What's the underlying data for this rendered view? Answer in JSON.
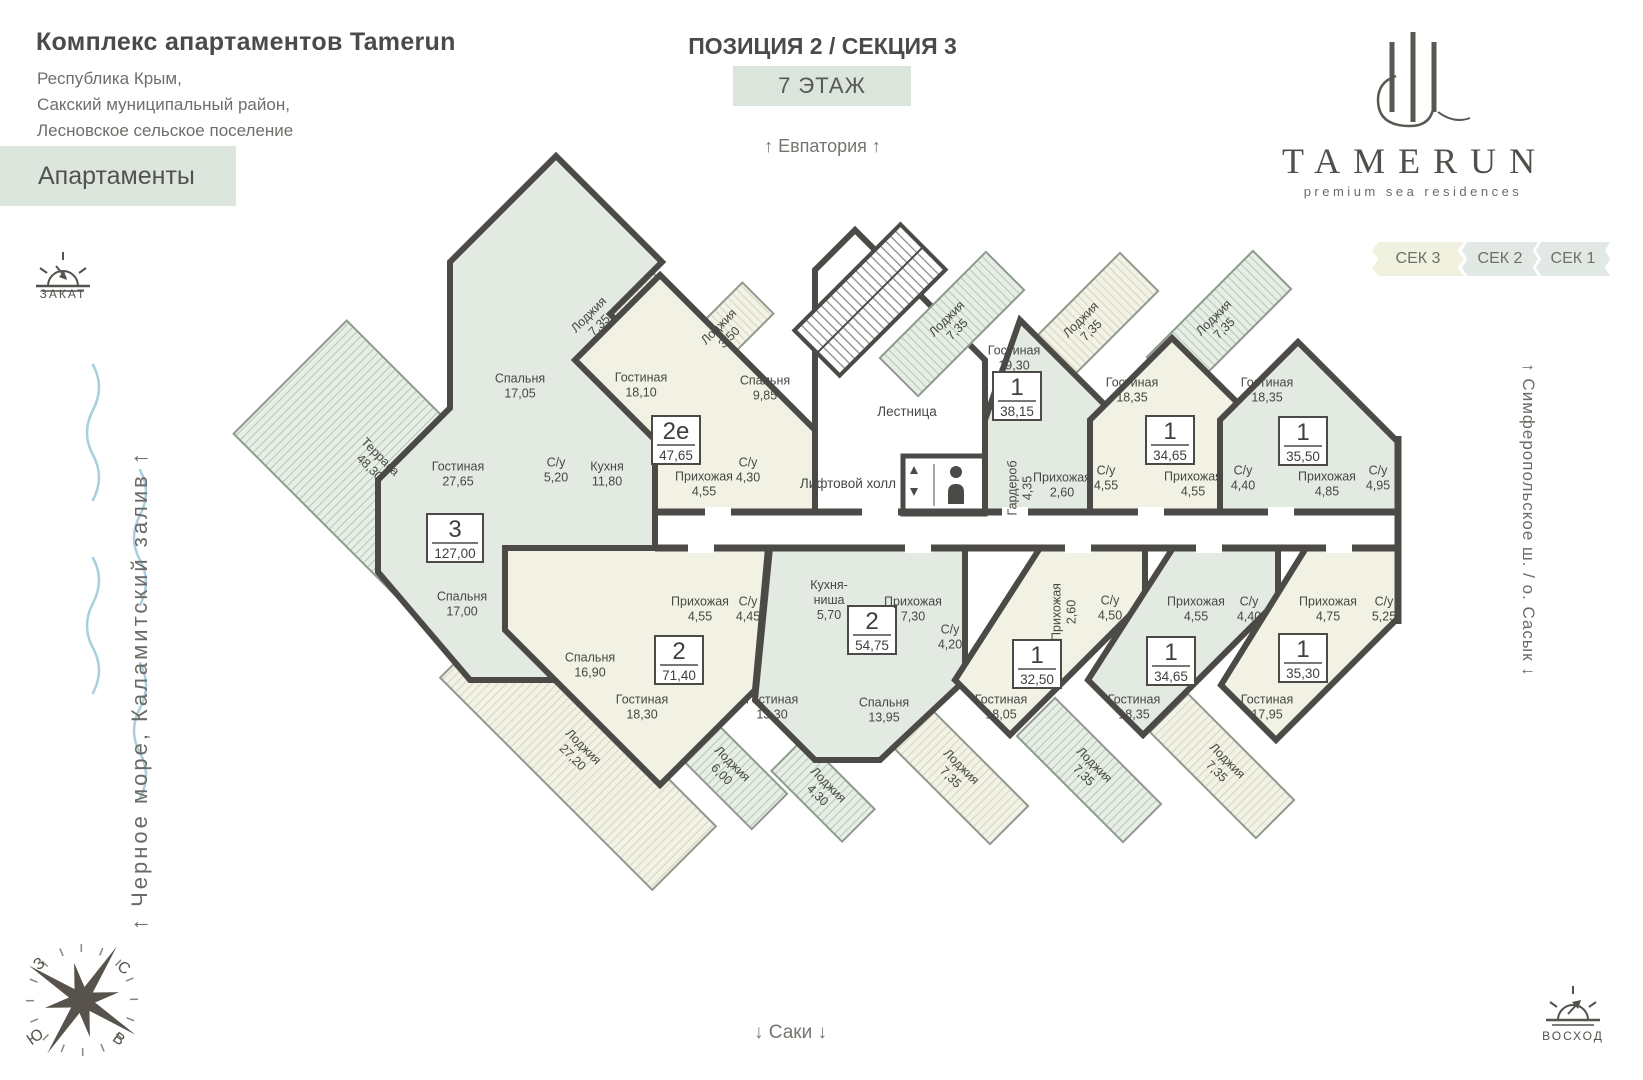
{
  "header": {
    "title": "Комплекс апартаментов Tamerun",
    "address": [
      "Республика Крым,",
      "Сакский муниципальный район,",
      "Лесновское сельское поселение"
    ],
    "apartments_badge": "Апартаменты",
    "position_title": "ПОЗИЦИЯ 2 / СЕКЦИЯ 3",
    "floor_badge": "7 ЭТАЖ",
    "direction_top": "↑ Евпатория ↑",
    "logo_word": "TAMERUN",
    "logo_tagline": "premium sea residences",
    "tabs": [
      {
        "id": "sec3",
        "label": "СЕК 3"
      },
      {
        "id": "sec2",
        "label": "СЕК 2"
      },
      {
        "id": "sec1",
        "label": "СЕК 1"
      }
    ]
  },
  "environment": {
    "sunset_label": "ЗАКАТ",
    "sunrise_label": "ВОСХОД",
    "left_vertical": "↑ Черное море, Каламитский залив ↑",
    "right_vertical": "↑ Симферопольское ш. / о. Сасык ↓",
    "direction_bottom": "↓ Саки ↓",
    "compass": {
      "n": "С",
      "s": "Ю",
      "w": "З",
      "e": "В"
    }
  },
  "plan": {
    "common_labels": [
      {
        "text": "Лестница",
        "x": 907,
        "y": 416
      },
      {
        "text": "Лифтовой холл",
        "x": 848,
        "y": 488
      }
    ],
    "colors": {
      "wall": "#4b4a47",
      "green": "#e3eae2",
      "cream": "#f1f1e4",
      "badge_bg": "#dde6dc"
    },
    "apartments": [
      {
        "id": "apt-3",
        "type": "3",
        "area": "127,00",
        "color": "green",
        "badge": {
          "x": 455,
          "y": 540
        },
        "shape": [
          [
            378,
            480
          ],
          [
            450,
            408
          ],
          [
            450,
            262
          ],
          [
            556,
            156
          ],
          [
            662,
            262
          ],
          [
            610,
            314
          ],
          [
            655,
            359
          ],
          [
            655,
            560
          ],
          [
            560,
            560
          ],
          [
            560,
            680
          ],
          [
            470,
            680
          ],
          [
            378,
            572
          ]
        ],
        "rooms": [
          {
            "name": "Спальня",
            "area": "17,05",
            "x": 520,
            "y": 386
          },
          {
            "name": "Гостиная",
            "area": "27,65",
            "x": 458,
            "y": 474
          },
          {
            "name": "С/у",
            "area": "5,20",
            "x": 556,
            "y": 470
          },
          {
            "name": "Кухня",
            "area": "11,80",
            "x": 607,
            "y": 474
          },
          {
            "name": "Спальня",
            "area": "17,00",
            "x": 462,
            "y": 604
          }
        ],
        "loggias": [
          {
            "name": "Терраса",
            "area": "48,30",
            "cx": 375,
            "cy": 462,
            "len": 240,
            "wid": 160,
            "rot": 45
          }
        ]
      },
      {
        "id": "apt-2e",
        "type": "2е",
        "area": "47,65",
        "color": "cream",
        "badge": {
          "x": 676,
          "y": 442
        },
        "shape": [
          [
            655,
            512
          ],
          [
            655,
            440
          ],
          [
            575,
            360
          ],
          [
            660,
            275
          ],
          [
            815,
            430
          ],
          [
            815,
            512
          ]
        ],
        "rooms": [
          {
            "name": "Гостиная",
            "area": "18,10",
            "x": 641,
            "y": 385
          },
          {
            "name": "Спальня",
            "area": "9,85",
            "x": 765,
            "y": 388
          },
          {
            "name": "Прихожая",
            "area": "4,55",
            "x": 704,
            "y": 484
          },
          {
            "name": "С/у",
            "area": "4,30",
            "x": 748,
            "y": 470
          }
        ],
        "loggias": [
          {
            "name": "Лоджия",
            "area": "7,35",
            "cx": 594,
            "cy": 320,
            "len": 150,
            "wid": 54,
            "rot": -45
          },
          {
            "name": "Лоджия",
            "area": "3,50",
            "cx": 724,
            "cy": 332,
            "len": 96,
            "wid": 44,
            "rot": -45
          }
        ]
      },
      {
        "id": "apt-1-3815",
        "type": "1",
        "area": "38,15",
        "color": "green",
        "badge": {
          "x": 1017,
          "y": 398
        },
        "shape": [
          [
            985,
            512
          ],
          [
            985,
            420
          ],
          [
            1020,
            320
          ],
          [
            1120,
            420
          ],
          [
            1120,
            512
          ]
        ],
        "rooms": [
          {
            "name": "Гостиная",
            "area": "19,30",
            "x": 1014,
            "y": 358
          },
          {
            "name": "Гардероб",
            "area": "4,35",
            "x": 1020,
            "y": 488,
            "rot": -90
          },
          {
            "name": "Прихожая",
            "area": "2,60",
            "x": 1062,
            "y": 485
          },
          {
            "name": "С/у",
            "area": "4,55",
            "x": 1106,
            "y": 478
          }
        ],
        "loggias": [
          {
            "name": "Лоджия",
            "area": "7,35",
            "cx": 952,
            "cy": 324,
            "len": 150,
            "wid": 54,
            "rot": -45
          }
        ]
      },
      {
        "id": "apt-1-3465t",
        "type": "1",
        "area": "34,65",
        "color": "cream",
        "badge": {
          "x": 1170,
          "y": 442
        },
        "shape": [
          [
            1090,
            512
          ],
          [
            1090,
            420
          ],
          [
            1172,
            338
          ],
          [
            1255,
            420
          ],
          [
            1255,
            512
          ]
        ],
        "rooms": [
          {
            "name": "Гостиная",
            "area": "18,35",
            "x": 1132,
            "y": 390
          },
          {
            "name": "Прихожая",
            "area": "4,55",
            "x": 1193,
            "y": 484
          },
          {
            "name": "С/у",
            "area": "4,40",
            "x": 1243,
            "y": 478
          }
        ],
        "loggias": [
          {
            "name": "Лоджия",
            "area": "7,35",
            "cx": 1086,
            "cy": 325,
            "len": 150,
            "wid": 54,
            "rot": -45
          }
        ]
      },
      {
        "id": "apt-1-3550",
        "type": "1",
        "area": "35,50",
        "color": "green",
        "badge": {
          "x": 1303,
          "y": 443
        },
        "shape": [
          [
            1220,
            512
          ],
          [
            1220,
            420
          ],
          [
            1298,
            342
          ],
          [
            1398,
            442
          ],
          [
            1398,
            512
          ]
        ],
        "rooms": [
          {
            "name": "Гостиная",
            "area": "18,35",
            "x": 1267,
            "y": 390
          },
          {
            "name": "Прихожая",
            "area": "4,85",
            "x": 1327,
            "y": 484
          },
          {
            "name": "С/у",
            "area": "4,95",
            "x": 1378,
            "y": 478
          }
        ],
        "loggias": [
          {
            "name": "Лоджия",
            "area": "7,35",
            "cx": 1219,
            "cy": 323,
            "len": 150,
            "wid": 54,
            "rot": -45
          }
        ]
      },
      {
        "id": "apt-2-7140",
        "type": "2",
        "area": "71,40",
        "color": "cream",
        "badge": {
          "x": 679,
          "y": 662
        },
        "shape": [
          [
            505,
            548
          ],
          [
            505,
            630
          ],
          [
            660,
            785
          ],
          [
            755,
            690
          ],
          [
            768,
            548
          ]
        ],
        "rooms": [
          {
            "name": "Спальня",
            "area": "16,90",
            "x": 590,
            "y": 665
          },
          {
            "name": "Гостиная",
            "area": "18,30",
            "x": 642,
            "y": 707
          },
          {
            "name": "Прихожая",
            "area": "4,55",
            "x": 700,
            "y": 609
          },
          {
            "name": "С/у",
            "area": "4,45",
            "x": 748,
            "y": 609
          }
        ],
        "loggias": [
          {
            "name": "Лоджия",
            "area": "27,20",
            "cx": 578,
            "cy": 752,
            "len": 300,
            "wid": 90,
            "rot": 45
          }
        ]
      },
      {
        "id": "apt-2-5475",
        "type": "2",
        "area": "54,75",
        "color": "green",
        "badge": {
          "x": 872,
          "y": 632
        },
        "shape": [
          [
            770,
            548
          ],
          [
            755,
            700
          ],
          [
            815,
            760
          ],
          [
            880,
            760
          ],
          [
            965,
            680
          ],
          [
            965,
            548
          ]
        ],
        "rooms": [
          {
            "name": "Кухня-ниша",
            "area": "5,70",
            "x": 829,
            "y": 600,
            "lines": [
              "Кухня-",
              "ниша",
              "5,70"
            ]
          },
          {
            "name": "Прихожая",
            "area": "7,30",
            "x": 913,
            "y": 609
          },
          {
            "name": "С/у",
            "area": "4,20",
            "x": 950,
            "y": 637
          },
          {
            "name": "Гостиная",
            "area": "13,30",
            "x": 772,
            "y": 707
          },
          {
            "name": "Спальня",
            "area": "13,95",
            "x": 884,
            "y": 710
          }
        ],
        "loggias": [
          {
            "name": "Лоджия",
            "area": "6,00",
            "cx": 727,
            "cy": 769,
            "len": 120,
            "wid": 50,
            "rot": 45
          },
          {
            "name": "Лоджия",
            "area": "4,30",
            "cx": 823,
            "cy": 790,
            "len": 100,
            "wid": 46,
            "rot": 45
          }
        ]
      },
      {
        "id": "apt-1-3250",
        "type": "1",
        "area": "32,50",
        "color": "cream",
        "badge": {
          "x": 1037,
          "y": 666
        },
        "shape": [
          [
            1040,
            548
          ],
          [
            1145,
            548
          ],
          [
            1145,
            600
          ],
          [
            1010,
            735
          ],
          [
            955,
            680
          ]
        ],
        "rooms": [
          {
            "name": "Прихожая",
            "area": "2,60",
            "x": 1064,
            "y": 612,
            "rot": -90
          },
          {
            "name": "С/у",
            "area": "4,50",
            "x": 1110,
            "y": 608
          },
          {
            "name": "Гостиная",
            "area": "18,05",
            "x": 1001,
            "y": 707
          }
        ],
        "loggias": [
          {
            "name": "Лоджия",
            "area": "7,35",
            "cx": 956,
            "cy": 772,
            "len": 150,
            "wid": 54,
            "rot": 45
          }
        ]
      },
      {
        "id": "apt-1-3465b",
        "type": "1",
        "area": "34,65",
        "color": "green",
        "badge": {
          "x": 1171,
          "y": 663
        },
        "shape": [
          [
            1173,
            548
          ],
          [
            1278,
            548
          ],
          [
            1278,
            600
          ],
          [
            1143,
            735
          ],
          [
            1088,
            680
          ]
        ],
        "rooms": [
          {
            "name": "Прихожая",
            "area": "4,55",
            "x": 1196,
            "y": 609
          },
          {
            "name": "С/у",
            "area": "4,40",
            "x": 1249,
            "y": 609
          },
          {
            "name": "Гостиная",
            "area": "18,35",
            "x": 1134,
            "y": 707
          }
        ],
        "loggias": [
          {
            "name": "Лоджия",
            "area": "7,35",
            "cx": 1089,
            "cy": 770,
            "len": 150,
            "wid": 54,
            "rot": 45
          }
        ]
      },
      {
        "id": "apt-1-3530",
        "type": "1",
        "area": "35,30",
        "color": "cream",
        "badge": {
          "x": 1303,
          "y": 660
        },
        "shape": [
          [
            1306,
            548
          ],
          [
            1398,
            548
          ],
          [
            1398,
            618
          ],
          [
            1276,
            740
          ],
          [
            1221,
            685
          ]
        ],
        "rooms": [
          {
            "name": "Прихожая",
            "area": "4,75",
            "x": 1328,
            "y": 609
          },
          {
            "name": "С/у",
            "area": "5,25",
            "x": 1384,
            "y": 609
          },
          {
            "name": "Гостиная",
            "area": "17,95",
            "x": 1267,
            "y": 707
          }
        ],
        "loggias": [
          {
            "name": "Лоджия",
            "area": "7,35",
            "cx": 1222,
            "cy": 766,
            "len": 150,
            "wid": 54,
            "rot": 45
          }
        ]
      }
    ]
  }
}
